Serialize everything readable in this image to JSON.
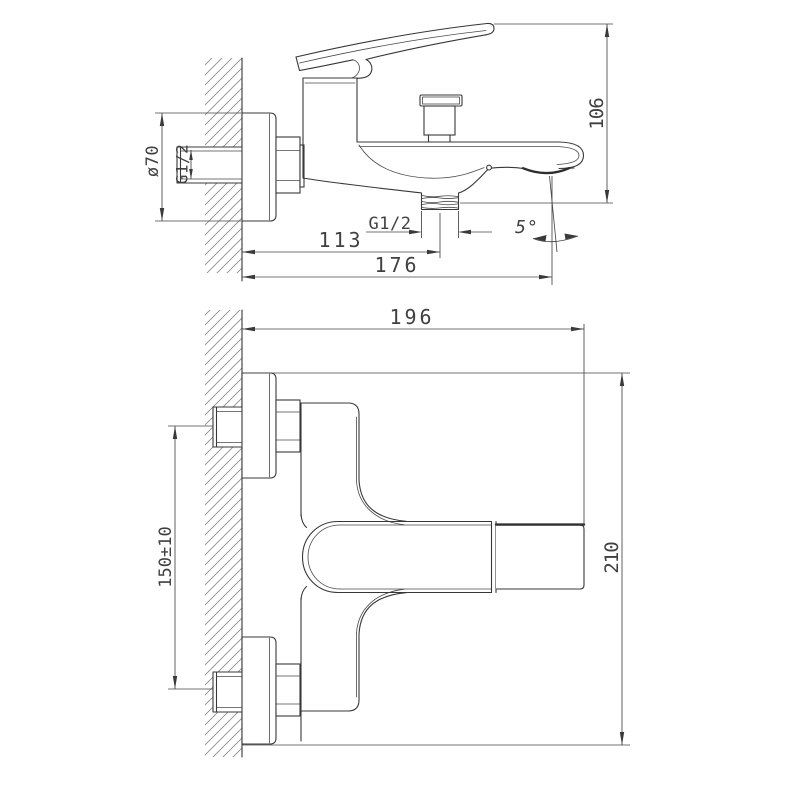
{
  "colors": {
    "background": "#ffffff",
    "object_line": "#383838",
    "dimension_line": "#464646",
    "hatch_line": "#8c8c8c",
    "text": "#404040"
  },
  "side_view": {
    "flange_diameter": "ø70",
    "inlet_thread": "G1/2",
    "outlet_thread": "G1/2",
    "wall_to_shower_outlet": "113",
    "wall_to_spout_outlet": "176",
    "spout_angle": "5°",
    "overall_height": "106"
  },
  "plan_view": {
    "spout_projection": "196",
    "inlet_spacing": "150±10",
    "overall_width": "210"
  }
}
